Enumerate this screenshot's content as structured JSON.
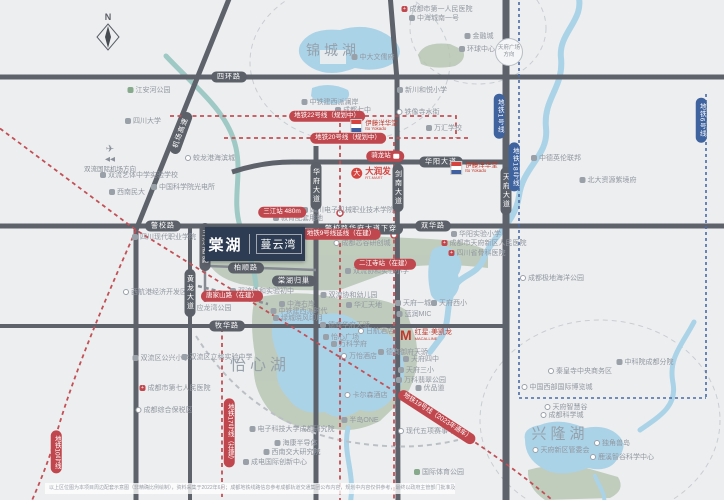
{
  "compass": {
    "label": "N"
  },
  "project": {
    "name_main": "棠湖",
    "name_sub": "蔓云湾"
  },
  "colors": {
    "accent_red": "#c0474d",
    "metro_blue": "#3f639f",
    "road": "#5d626b",
    "water": "#abd3e8",
    "river_teal": "#9fc9c4",
    "green": "#b7c6b3"
  },
  "lake_labels": [
    {
      "text": "锦城湖",
      "x": 333,
      "y": 50,
      "size": 14
    },
    {
      "text": "怡心湖",
      "x": 260,
      "y": 363,
      "size": 16
    },
    {
      "text": "兴隆湖",
      "x": 560,
      "y": 433,
      "size": 15
    }
  ],
  "road_badges": [
    {
      "text": "四环路",
      "x": 229,
      "y": 77
    },
    {
      "text": "警校路",
      "x": 163,
      "y": 226
    },
    {
      "text": "双华路",
      "x": 433,
      "y": 226
    },
    {
      "text": "华阳大道",
      "x": 441,
      "y": 162
    },
    {
      "text": "牧华路",
      "x": 227,
      "y": 326
    },
    {
      "text": "柏顺路",
      "x": 246,
      "y": 268
    },
    {
      "text": "警校路华府大道下穿",
      "x": 361,
      "y": 229
    },
    {
      "text": "棠湖归巢",
      "x": 294,
      "y": 281
    },
    {
      "text": "机场高速",
      "x": 181,
      "y": 133,
      "rot": -70
    },
    {
      "text": "黄龙大道",
      "x": 190,
      "y": 293,
      "v": true
    },
    {
      "text": "三江西路",
      "x": 205,
      "y": 247,
      "v": true
    },
    {
      "text": "华府大道",
      "x": 316,
      "y": 186,
      "v": true
    },
    {
      "text": "剑南大道",
      "x": 398,
      "y": 188,
      "v": true
    },
    {
      "text": "天府大道",
      "x": 506,
      "y": 191,
      "v": true
    }
  ],
  "metro_badges": [
    {
      "text": "地铁22号线（规划中）",
      "x": 327,
      "y": 116
    },
    {
      "text": "地铁20号线（规划中）",
      "x": 348,
      "y": 138
    },
    {
      "text": "地铁9号线延线（在建）",
      "x": 341,
      "y": 234
    },
    {
      "text": "二江寺站（在建）",
      "x": 385,
      "y": 264
    },
    {
      "text": "三江站 480m",
      "x": 282,
      "y": 212
    },
    {
      "text": "骑龙站",
      "x": 385,
      "y": 156,
      "bus": true
    },
    {
      "text": "唐家山路（在建）",
      "x": 232,
      "y": 296
    },
    {
      "text": "地铁19号线（2023年通车）",
      "x": 437,
      "y": 417,
      "rot": 33
    },
    {
      "text": "地铁17号线（在建）",
      "x": 229,
      "y": 433,
      "v": true
    },
    {
      "text": "地铁10号线",
      "x": 56,
      "y": 452,
      "v": true
    }
  ],
  "blue_badges": [
    {
      "text": "地铁1号线",
      "x": 499,
      "y": 116
    },
    {
      "text": "地铁18号线",
      "x": 514,
      "y": 167
    },
    {
      "text": "地铁6号线",
      "x": 701,
      "y": 120
    }
  ],
  "directions": [
    {
      "text": "天府广场方向",
      "x": 509,
      "y": 52
    },
    {
      "text": "双流国际机场方向",
      "arrows": "◀◀",
      "x": 110,
      "y": 159
    }
  ],
  "brands": {
    "yokado1": {
      "line1": "伊藤洋华堂",
      "line2": "Ito Yokado",
      "x": 374,
      "y": 126
    },
    "yokado2": {
      "line1": "伊藤洋华堂",
      "line2": "Ito Yokado",
      "x": 474,
      "y": 168
    },
    "rtmart": {
      "text": "大润发",
      "sub": "RT-MART",
      "x": 371,
      "y": 173
    },
    "macalline": {
      "m": "M",
      "line1": "红星·美凯龙",
      "line2": "MACALLINE",
      "x": 426,
      "y": 335
    }
  },
  "pois": [
    {
      "text": "成都市第一人民医院",
      "x": 437,
      "y": 9,
      "icon": "hospital"
    },
    {
      "text": "中海城南一号",
      "x": 434,
      "y": 18,
      "icon": "building"
    },
    {
      "text": "中大文儒府",
      "x": 373,
      "y": 57,
      "icon": "building"
    },
    {
      "text": "金融城",
      "x": 479,
      "y": 36,
      "icon": "building"
    },
    {
      "text": "环球中心",
      "x": 477,
      "y": 49,
      "icon": "building"
    },
    {
      "text": "新川和悦小学",
      "x": 422,
      "y": 90,
      "icon": "school"
    },
    {
      "text": "中铁建西派澜岸",
      "x": 330,
      "y": 102,
      "icon": "building"
    },
    {
      "text": "成都七中",
      "x": 353,
      "y": 110,
      "icon": "school"
    },
    {
      "text": "铁像寺水街",
      "x": 418,
      "y": 112,
      "icon": "landmark"
    },
    {
      "text": "万汇学校",
      "x": 444,
      "y": 128,
      "icon": "school"
    },
    {
      "text": "蛟龙港海滨城",
      "x": 210,
      "y": 158,
      "icon": "landmark"
    },
    {
      "text": "四川大学",
      "x": 143,
      "y": 121,
      "icon": "school"
    },
    {
      "text": "江安河公园",
      "x": 149,
      "y": 90,
      "icon": "park"
    },
    {
      "text": "双流艺体中学实验学校",
      "x": 139,
      "y": 175,
      "icon": "school"
    },
    {
      "text": "西南民大",
      "x": 127,
      "y": 192,
      "icon": "school"
    },
    {
      "text": "中国科学院光电所",
      "x": 183,
      "y": 187,
      "icon": "building"
    },
    {
      "text": "四川现代职业学院",
      "x": 164,
      "y": 237,
      "icon": "school"
    },
    {
      "text": "西航港经济开发区",
      "x": 155,
      "y": 292,
      "icon": "landmark"
    },
    {
      "text": "四川电子机械职业技术学院",
      "x": 348,
      "y": 210,
      "icon": "school"
    },
    {
      "text": "教育配套用地",
      "x": 298,
      "y": 218,
      "icon": "school"
    },
    {
      "text": "三江公园",
      "x": 264,
      "y": 257,
      "icon": "park"
    },
    {
      "text": "成都芯谷研创城",
      "x": 362,
      "y": 243,
      "icon": "landmark"
    },
    {
      "text": "双流协和实验小学",
      "x": 377,
      "y": 271,
      "icon": "school"
    },
    {
      "text": "双流协和幼儿园",
      "x": 349,
      "y": 295,
      "icon": "school"
    },
    {
      "text": "双流协和实验初中",
      "x": 262,
      "y": 291,
      "icon": "school"
    },
    {
      "text": "应龙湾公园",
      "x": 210,
      "y": 308,
      "icon": "park"
    },
    {
      "text": "中德英伦联邦",
      "x": 556,
      "y": 158,
      "icon": "building"
    },
    {
      "text": "北大资源紫境府",
      "x": 608,
      "y": 180,
      "icon": "building"
    },
    {
      "text": "华阳实验小学",
      "x": 476,
      "y": 234,
      "icon": "school"
    },
    {
      "text": "成都市天府新区人民医院",
      "x": 484,
      "y": 243,
      "icon": "hospital"
    },
    {
      "text": "四川省骨科医院",
      "x": 477,
      "y": 253,
      "icon": "hospital"
    },
    {
      "text": "成都极地海洋公园",
      "x": 552,
      "y": 278,
      "icon": "landmark"
    },
    {
      "text": "天府一城",
      "x": 413,
      "y": 303,
      "icon": "building"
    },
    {
      "text": "天府西小",
      "x": 449,
      "y": 303,
      "icon": "school"
    },
    {
      "text": "蓝润MIC",
      "x": 414,
      "y": 314,
      "icon": "building"
    },
    {
      "text": "中海右岸",
      "x": 297,
      "y": 304,
      "icon": "building"
    },
    {
      "text": "中铁建西派时代",
      "x": 299,
      "y": 311,
      "icon": "building"
    },
    {
      "text": "绿城晓风印月",
      "x": 298,
      "y": 318,
      "icon": "building"
    },
    {
      "text": "华汇天地",
      "x": 364,
      "y": 305,
      "icon": "building"
    },
    {
      "text": "德商华府天骄",
      "x": 345,
      "y": 325,
      "icon": "building"
    },
    {
      "text": "日航酒店",
      "x": 376,
      "y": 331,
      "icon": "landmark"
    },
    {
      "text": "怡心广场",
      "x": 341,
      "y": 337,
      "icon": "building"
    },
    {
      "text": "万科学府",
      "x": 349,
      "y": 344,
      "icon": "building"
    },
    {
      "text": "万怡酒店",
      "x": 359,
      "y": 356,
      "icon": "landmark"
    },
    {
      "text": "德商御府天骄",
      "x": 403,
      "y": 352,
      "icon": "building"
    },
    {
      "text": "天府四中",
      "x": 421,
      "y": 359,
      "icon": "school"
    },
    {
      "text": "天府三小",
      "x": 416,
      "y": 370,
      "icon": "school"
    },
    {
      "text": "万科翡翠公园",
      "x": 421,
      "y": 380,
      "icon": "building"
    },
    {
      "text": "优品道",
      "x": 430,
      "y": 388,
      "icon": "building"
    },
    {
      "text": "卡尔森酒店",
      "x": 366,
      "y": 395,
      "icon": "landmark"
    },
    {
      "text": "半岛ONE",
      "x": 360,
      "y": 420,
      "icon": "building"
    },
    {
      "text": "电子科技大学成都研究院",
      "x": 292,
      "y": 429,
      "icon": "school"
    },
    {
      "text": "海康半导体",
      "x": 296,
      "y": 443,
      "icon": "building"
    },
    {
      "text": "西南交大研究院",
      "x": 292,
      "y": 452,
      "icon": "school"
    },
    {
      "text": "成电国际创新中心",
      "x": 275,
      "y": 462,
      "icon": "building"
    },
    {
      "text": "现代五项赛事中心",
      "x": 430,
      "y": 431,
      "icon": "landmark"
    },
    {
      "text": "国际体育公园",
      "x": 439,
      "y": 472,
      "icon": "park"
    },
    {
      "text": "双流区公兴小学",
      "x": 161,
      "y": 358,
      "icon": "school"
    },
    {
      "text": "双流区立格实验中学",
      "x": 217,
      "y": 357,
      "icon": "school"
    },
    {
      "text": "成都市第七人民医院",
      "x": 175,
      "y": 388,
      "icon": "hospital"
    },
    {
      "text": "成都综合保税区",
      "x": 164,
      "y": 410,
      "icon": "landmark"
    },
    {
      "text": "秦皇寺中央商务区",
      "x": 580,
      "y": 371,
      "icon": "landmark"
    },
    {
      "text": "中国西部国际博览城",
      "x": 557,
      "y": 387,
      "icon": "landmark"
    },
    {
      "text": "天府智慧谷",
      "x": 566,
      "y": 407,
      "icon": "landmark"
    },
    {
      "text": "成都科学城",
      "x": 562,
      "y": 415,
      "icon": "landmark"
    },
    {
      "text": "天府新区管委会",
      "x": 561,
      "y": 450,
      "icon": "landmark"
    },
    {
      "text": "独角兽岛",
      "x": 612,
      "y": 443,
      "icon": "landmark"
    },
    {
      "text": "鹿溪智谷科学中心",
      "x": 622,
      "y": 457,
      "icon": "landmark"
    },
    {
      "text": "中科院成都分院",
      "x": 645,
      "y": 362,
      "icon": "building"
    }
  ],
  "disclaimer": "以上区位图为本项目周边配套示意图（非精确比例绘制），资料采集于2022年6月；成都地铁线路信息参考成都轨道交通集团公布内容，规划中内容仅供参考，最终以政府主管部门批准及实际建成为准，本资料不构成要约或承诺。"
}
